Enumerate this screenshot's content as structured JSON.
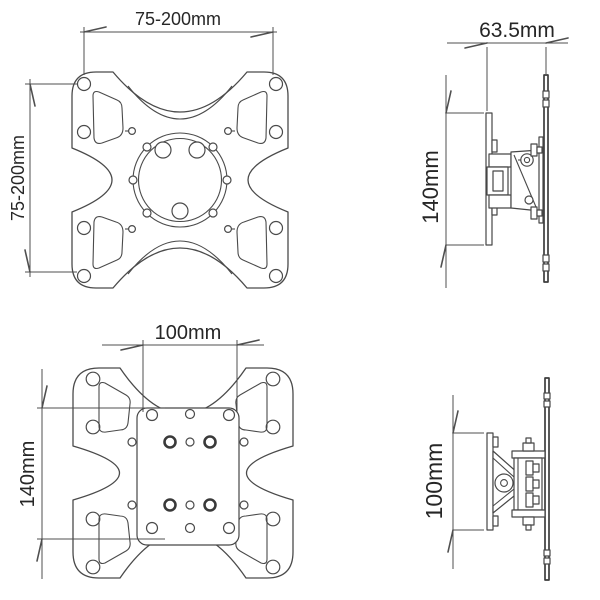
{
  "canvas": {
    "background": "#ffffff",
    "line_color": "#4a4a4a",
    "text_color": "#262626"
  },
  "views": {
    "front_top": {
      "width_label": "75-200mm",
      "height_label": "75-200mm"
    },
    "side_top": {
      "depth_label": "63.5mm",
      "height_label": "140mm"
    },
    "front_bottom": {
      "width_label": "100mm",
      "height_label": "140mm"
    },
    "side_bottom": {
      "height_label": "100mm"
    }
  }
}
